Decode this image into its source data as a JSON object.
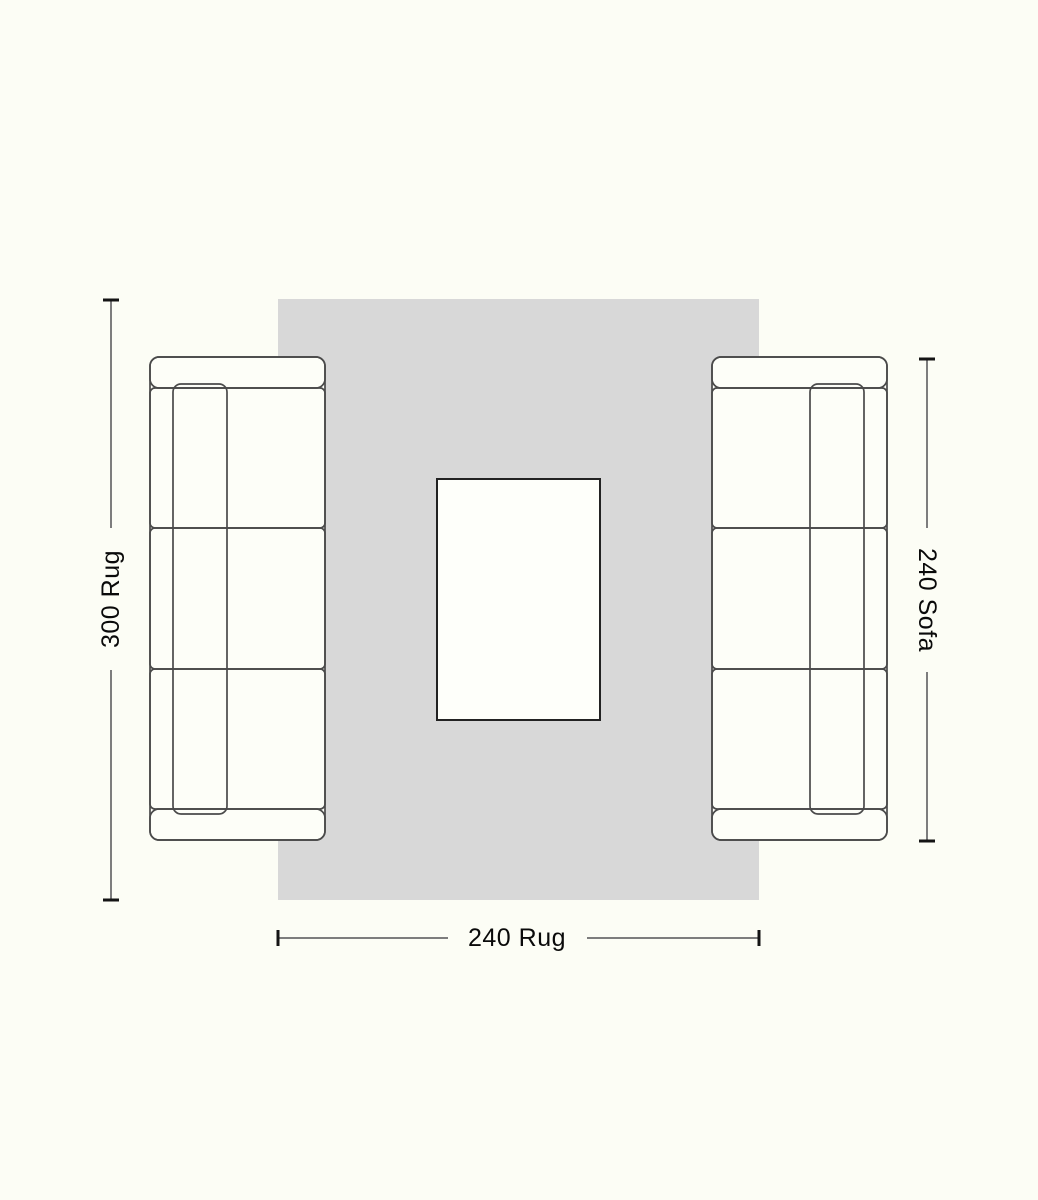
{
  "diagram": {
    "labels": {
      "rug_length": "300 Rug",
      "sofa_length": "240 Sofa",
      "rug_width": "240 Rug"
    },
    "colors": {
      "background": "#FCFDF5",
      "rug_fill": "#D8D8D8",
      "furniture_fill": "#FDFEF8",
      "furniture_outline": "#4A4A4A",
      "table_outline": "#222222",
      "dimension_line": "#7D7D7D",
      "dimension_tick": "#141414",
      "label_text": "#0A0A0A"
    }
  }
}
